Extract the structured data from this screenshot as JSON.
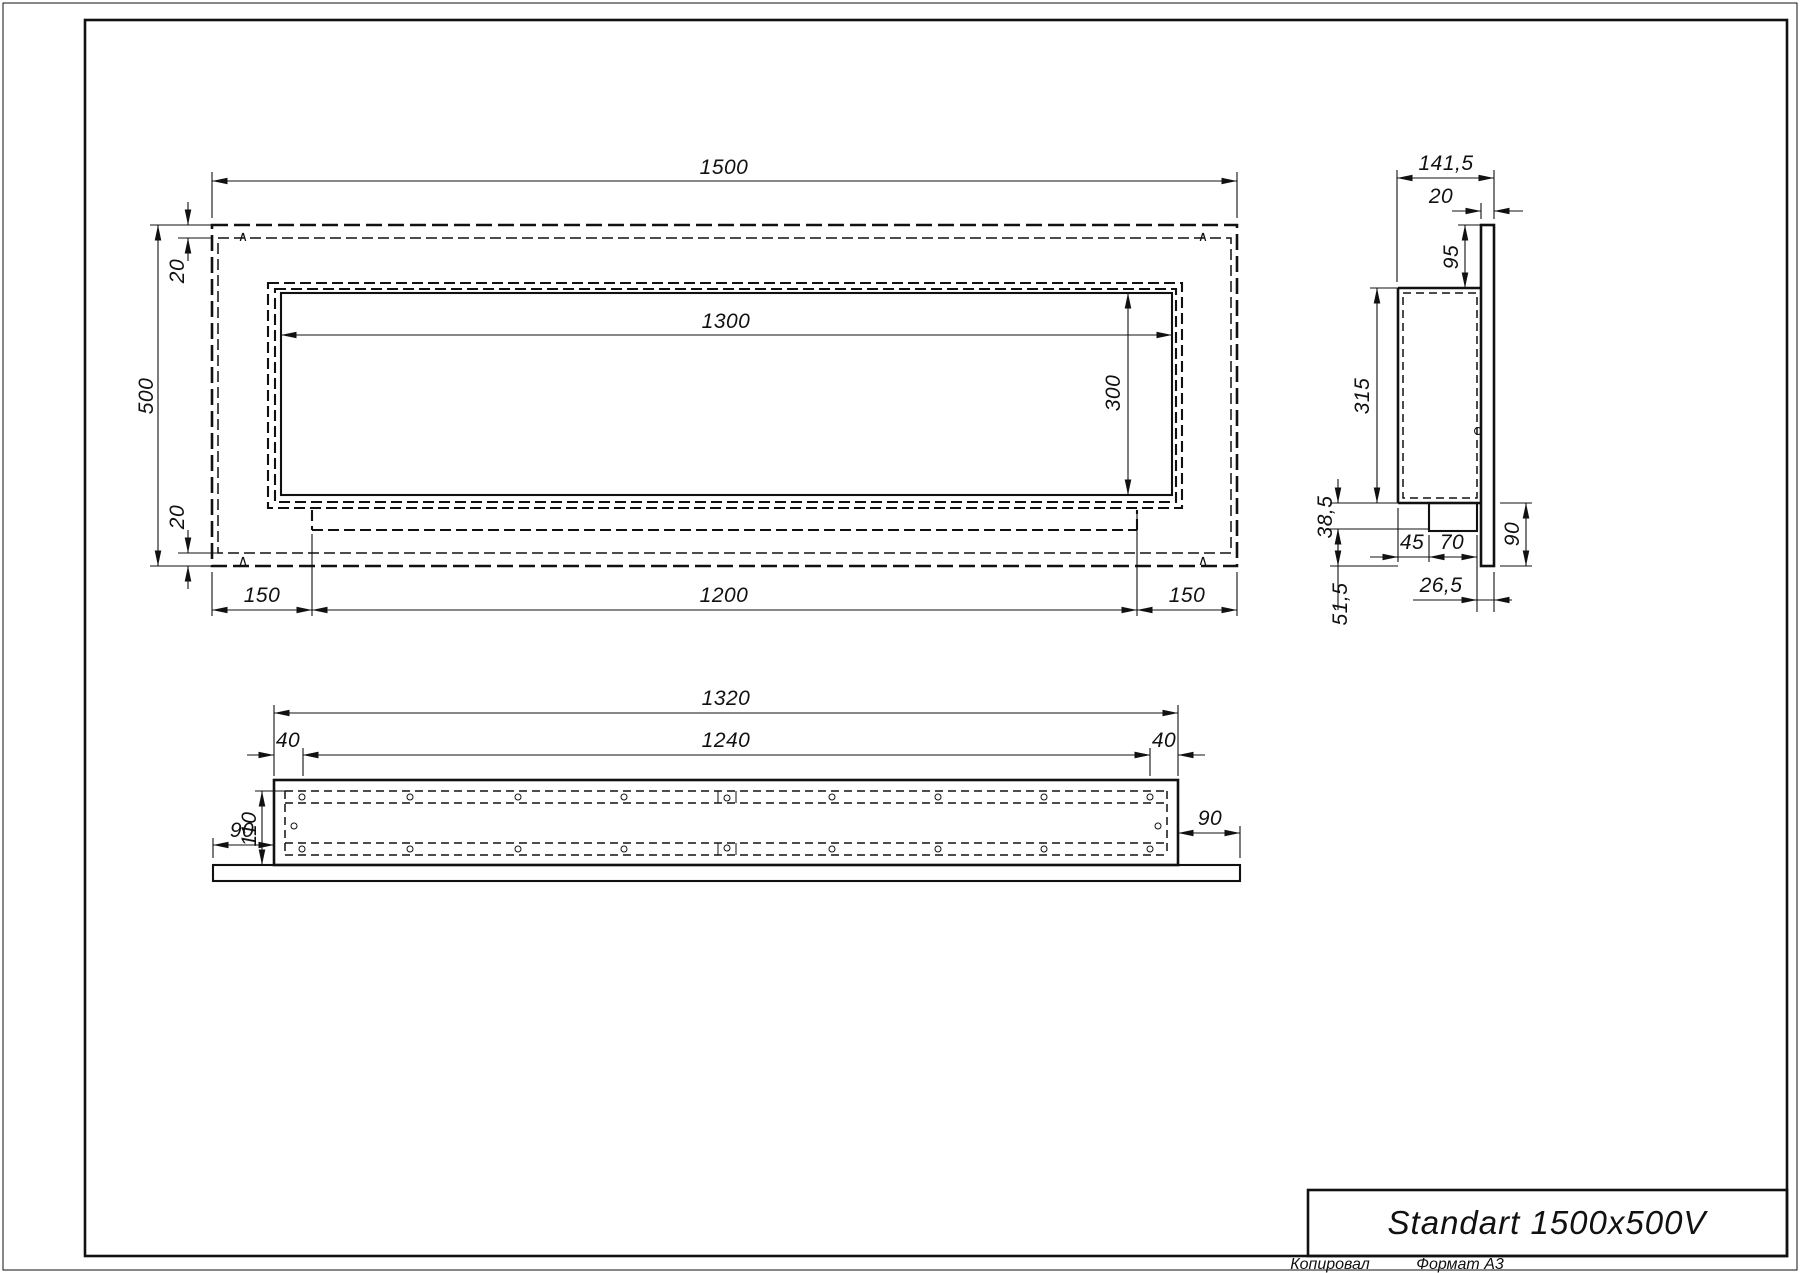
{
  "sheet": {
    "title": "Standart 1500x500V",
    "copied_label": "Копировал",
    "format_label": "Формат А3"
  },
  "front_view": {
    "dim_width_total": "1500",
    "dim_height_total": "500",
    "dim_flange_top": "20",
    "dim_flange_bottom": "20",
    "dim_opening_width": "1300",
    "dim_opening_height": "300",
    "dim_margin_left": "150",
    "dim_slot_width": "1200",
    "dim_margin_right": "150",
    "mark": "∧"
  },
  "side_view": {
    "dim_depth_total": "141,5",
    "dim_plate_thickness": "20",
    "dim_top_offset": "95",
    "dim_body_height": "315",
    "dim_tray_height": "38,5",
    "dim_tray_offset": "45",
    "dim_tray_width": "70",
    "dim_plate_bottom": "90",
    "dim_tray_inset": "26,5",
    "dim_bottom_offset": "51,5"
  },
  "bottom_view": {
    "dim_width_total": "1320",
    "dim_slot_width": "1240",
    "dim_margin_left": "40",
    "dim_margin_right": "40",
    "dim_flange_left": "90",
    "dim_flange_right": "90",
    "dim_depth": "110"
  },
  "colors": {
    "line": "#111111",
    "background": "#ffffff"
  }
}
